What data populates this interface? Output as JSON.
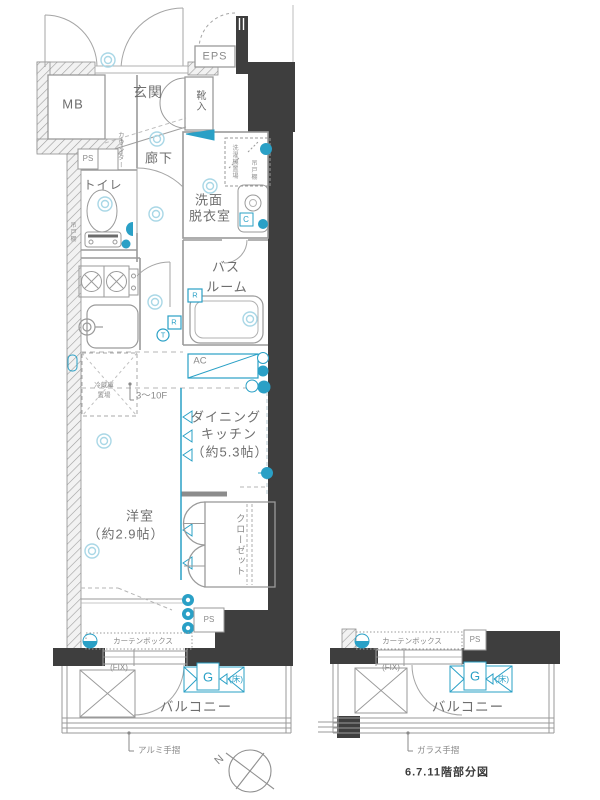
{
  "palette": {
    "accent_cyan": "#2aa0c6",
    "pale_cyan": "#a9d7e6",
    "wall_dark": "#3e3e3e",
    "line_gray": "#999999",
    "label_gray": "#6e6e6e"
  },
  "main_plan": {
    "mb": "MB",
    "genkan": "玄関",
    "shoe_box": "靴入",
    "eps": "EPS",
    "counter": "カウンター",
    "hallway": "廊下",
    "ps_upper": "PS",
    "toilet": "トイレ",
    "hanging_shelf_toilet": "吊戸棚",
    "washroom_l1": "洗面",
    "washroom_l2": "脱衣室",
    "laundry_space": "洗濯機置場",
    "hanging_shelf_wash": "吊戸棚",
    "c_mark": "C",
    "bath_l1": "バス",
    "bath_l2": "ルーム",
    "r_mark_1": "R",
    "r_mark_2": "R",
    "t_mark": "T",
    "ac": "AC",
    "fridge_l1": "冷蔵庫",
    "fridge_l2": "置場",
    "floor_range": "3～10F",
    "dk_l1": "ダイニング",
    "dk_l2": "キッチン",
    "dk_l3": "（約5.3帖）",
    "western_l1": "洋室",
    "western_l2": "（約2.9帖）",
    "closet": "クローゼット",
    "ps_lower": "PS",
    "curtain_box": "カーテンボックス",
    "fix": "(FIX)",
    "g_mark": "G",
    "floor_mark": "(床)",
    "balcony": "バルコニー",
    "handrail": "アルミ手摺"
  },
  "partial_plan": {
    "curtain_box": "カーテンボックス",
    "ps": "PS",
    "fix": "(FIX)",
    "g_mark": "G",
    "floor_mark": "(床)",
    "balcony": "バルコニー",
    "handrail": "ガラス手摺",
    "caption": "6.7.11階部分図"
  },
  "compass": {
    "north_label": "N"
  }
}
